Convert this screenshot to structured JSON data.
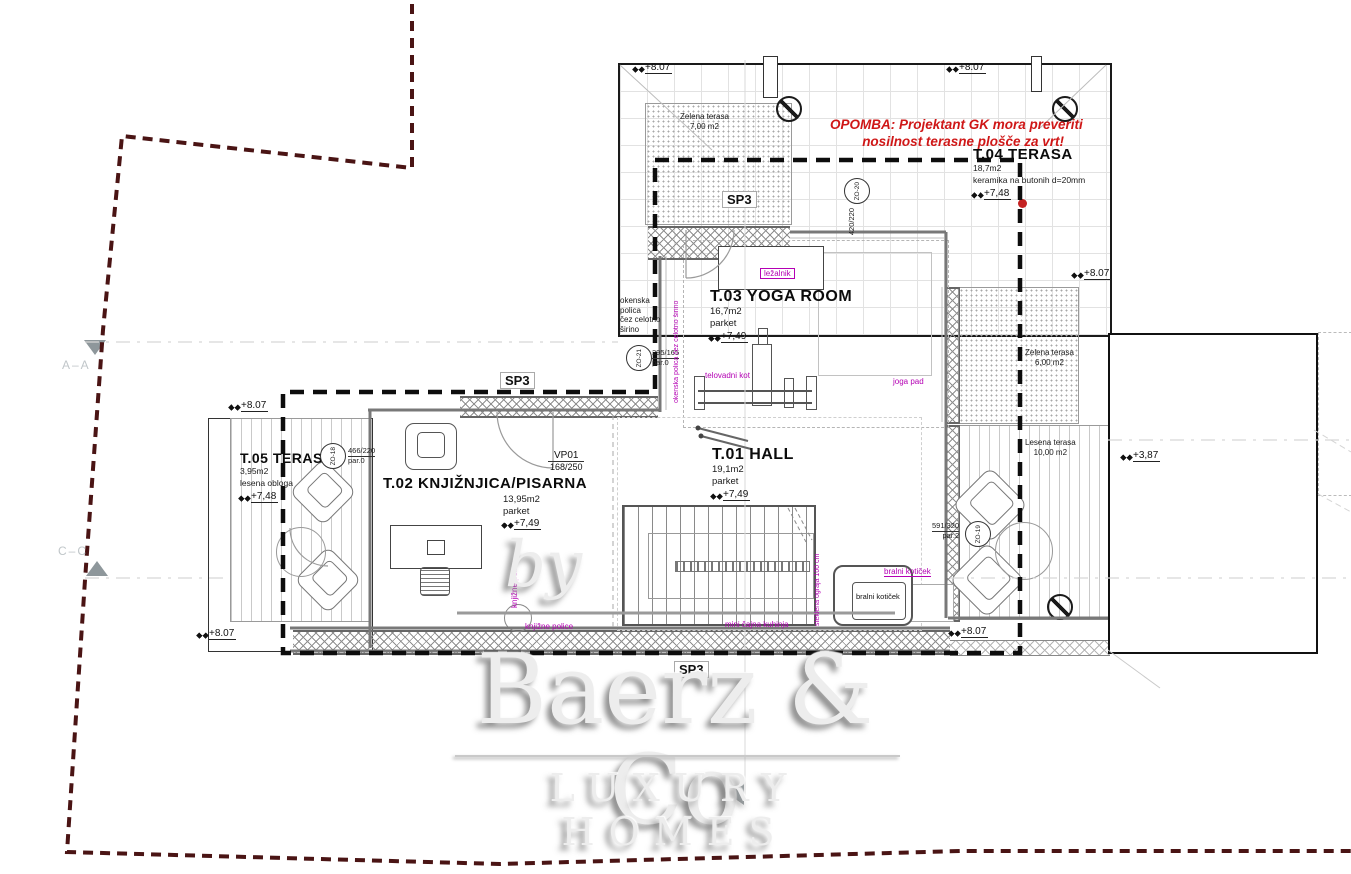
{
  "note": {
    "line1": "OPOMBA: Projektant GK mora preveriti",
    "line2": "nosilnost terasne plošče za vrt!"
  },
  "rooms": {
    "t01": {
      "name": "T.01 HALL",
      "area": "19,1m2",
      "finish": "parket",
      "level": "+7,49"
    },
    "t02": {
      "name": "T.02 KNJIŽNJICA/PISARNA",
      "area": "13,95m2",
      "finish": "parket",
      "level": "+7,49"
    },
    "t03": {
      "name": "T.03 YOGA ROOM",
      "area": "16,7m2",
      "finish": "parket",
      "level": "+7,49"
    },
    "t04": {
      "name": "T.04 TERASA",
      "area": "18,7m2",
      "finish": "keramika na butonih d=20mm",
      "level": "+7,48"
    },
    "t05": {
      "name": "T.05 TERASA",
      "area": "3,95m2",
      "finish": "lesena obloga",
      "level": "+7,48"
    }
  },
  "terraces": {
    "zelena7": {
      "name": "Zelena terasa",
      "area": "7,00 m2"
    },
    "zelena6": {
      "name": "Zelena terasa",
      "area": "6,00 m2"
    },
    "lesena10": {
      "name": "Lesena terasa",
      "area": "10,00 m2"
    }
  },
  "levels": {
    "l807": "+8.07",
    "l387": "+3,87"
  },
  "sp3": "SP3",
  "door": {
    "code": "VP01",
    "size": "168/250"
  },
  "windows": {
    "zo18": {
      "code": "ZO-18",
      "size": "466/220",
      "sub": "par.0"
    },
    "zo19": {
      "code": "ZO-19",
      "size": "591/320",
      "sub": "par.2"
    },
    "zo20": {
      "code": "ZO-20",
      "size": "420/220",
      "sub": "par.0"
    },
    "zo21": {
      "code": "ZO-21",
      "size": "295/165",
      "sub": "par.0"
    }
  },
  "annotations": {
    "lezalnik": "ležalnik",
    "telovadni_kot": "telovadni kot",
    "joga_pad": "joga pad",
    "bralni_koticek": "bralni kotiček",
    "knjizne_police": "knjižne police",
    "mini_cajna_kuhinja": "mini čajna kuhinja",
    "steklena_ograja": "steklena ograja 100 cm",
    "okenska_polica_v": "okenska polica čez celotno širino",
    "okenska_polica_l1": "okenska polica",
    "okenska_polica_l2": "čez celotno",
    "okenska_polica_l3": "širino"
  },
  "sections": {
    "aa": "A–A",
    "cc": "C–C"
  },
  "watermark": {
    "by": "by",
    "name": "Baerz & Co",
    "tagline": "LUXURY HOMES"
  }
}
